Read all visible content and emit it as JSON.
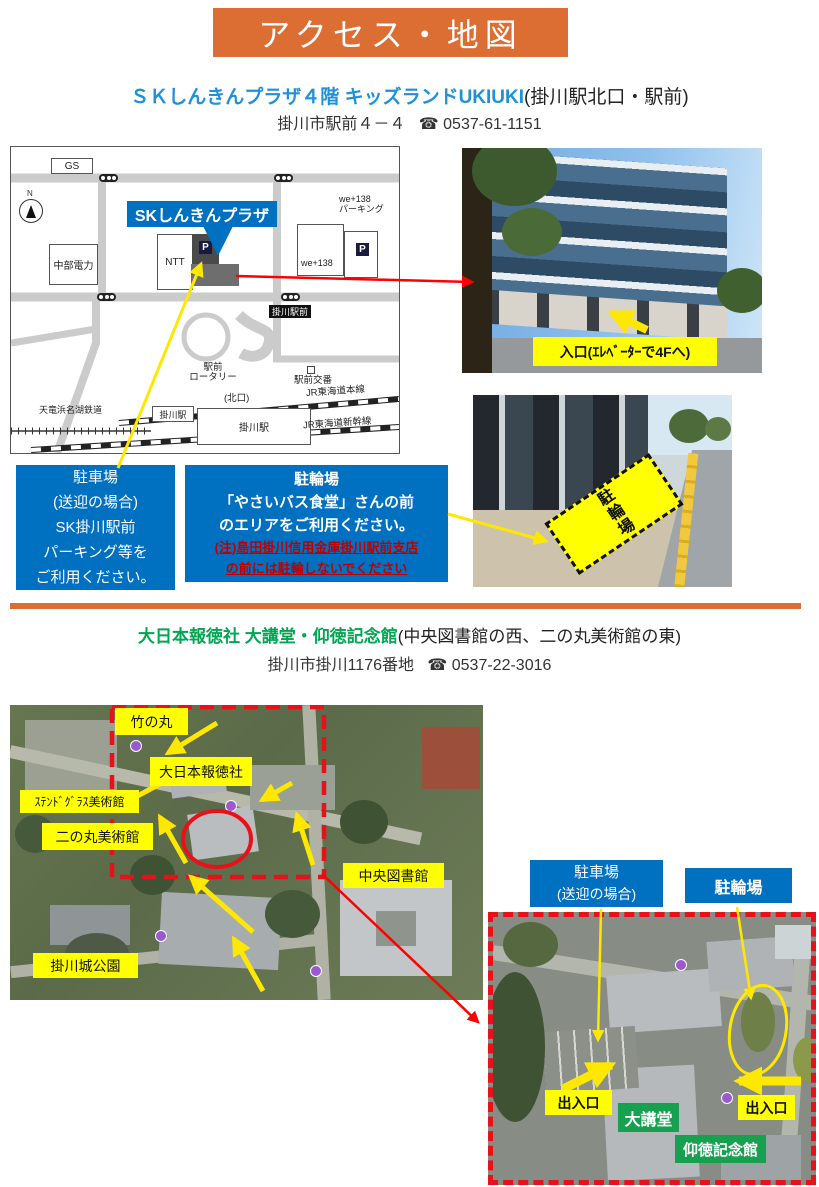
{
  "title": "アクセス・地図",
  "s1": {
    "name": "ＳＫしんきんプラザ４階 キッズランドUKIUKI",
    "name_note": "(掛川駅北口・駅前)",
    "address": "掛川市駅前４－４",
    "tel_icon": "☎",
    "tel": "0537-61-1151",
    "map": {
      "gs": "GS",
      "north": "N",
      "callout": "SKしんきんプラザ",
      "chubu_denryoku": "中部電力",
      "ntt": "NTT",
      "p": "P",
      "we138": "we+138",
      "we138_parking": "we+138\nパーキング",
      "kakegawa_ekimae": "掛川駅前",
      "rotary": "駅前\nロータリー",
      "koban": "駅前交番",
      "kitaguchi": "(北口)",
      "tenhama_line": "天竜浜名湖鉄道",
      "kakegawa_sta_tenhama": "掛川駅",
      "kakegawa_sta": "掛川駅",
      "jr_tokaido": "JR東海道本線",
      "jr_shinkansen": "JR東海道新幹線"
    },
    "photo1_label": "入口(ｴﾚﾍﾞｰﾀｰで4Fへ)",
    "photo2_label": "駐輪場",
    "car_box": {
      "l1": "駐車場",
      "l2": "(送迎の場合)",
      "l3": "SK掛川駅前",
      "l4": "パーキング等を",
      "l5": "ご利用ください。"
    },
    "cycle_box": {
      "l1": "駐輪場",
      "l2": "「やさいバス食堂」さんの前",
      "l3": "のエリアをご利用ください。",
      "r1": "(注)島田掛川信用金庫掛川駅前支店",
      "r2": "の前には駐輪しないでください"
    }
  },
  "s2": {
    "name": "大日本報徳社 大講堂・仰徳記念館",
    "name_note": "(中央図書館の西、二の丸美術館の東)",
    "address": "掛川市掛川1176番地",
    "tel_icon": "☎",
    "tel": "0537-22-3016",
    "aerial": {
      "takenomaru": "竹の丸",
      "hotokusha": "大日本報徳社",
      "stained_glass": "ｽﾃﾝﾄﾞｸﾞﾗｽ美術館",
      "ninomaru": "二の丸美術館",
      "library": "中央図書館",
      "castle_park": "掛川城公園"
    },
    "inset": {
      "car1": "駐車場",
      "car2": "(送迎の場合)",
      "cycle": "駐輪場",
      "exit_l": "出入口",
      "exit_r": "出入口",
      "hall": "大講堂",
      "memorial": "仰徳記念館"
    }
  },
  "colors": {
    "accent_orange": "#DD6E33",
    "brand_blue": "#0070C0",
    "heading_blue": "#2090D8",
    "heading_green": "#00A651",
    "highlight_yellow": "#FFFF00",
    "alert_red": "#FF0000",
    "note_red": "#C00000",
    "label_green": "#17A050"
  }
}
